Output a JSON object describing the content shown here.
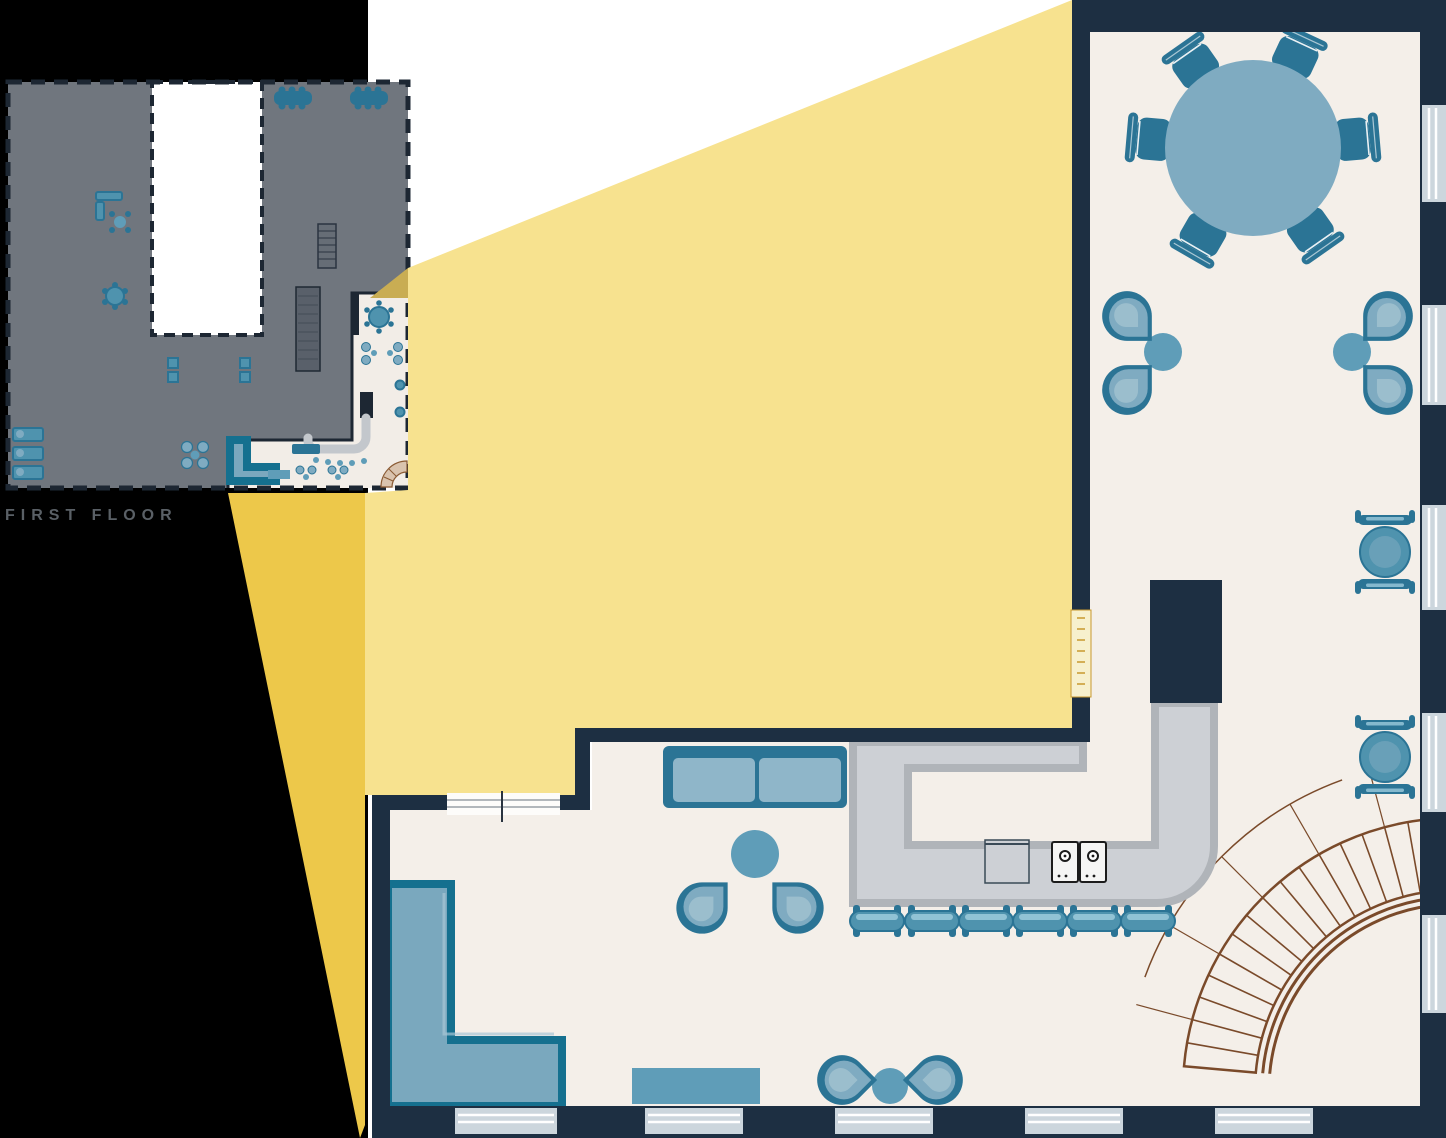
{
  "illustration": {
    "type": "architectural floor plan callout",
    "description": "Small first-floor building plan with yellow spotlight beam expanding a corner cafe/bar area into a large detailed plan"
  },
  "mini_plan": {
    "label": "FIRST FLOOR",
    "highlighted_area": "bottom-right corner cafe"
  },
  "big_plan": {
    "dining_chairs": 6,
    "bar_stools": 6,
    "lounge_chairs": 8,
    "armchairs": 2,
    "sofas": 2,
    "side_tables": 4,
    "right_wall_windows": 5,
    "bottom_wall_windows": 5,
    "appliances": [
      "sink",
      "cooktop",
      "cooktop"
    ],
    "features": [
      "round dining table",
      "bar counter",
      "L-shaped sectional sofa",
      "bench",
      "curved staircase",
      "column"
    ]
  },
  "colors": {
    "background_black": "#000000",
    "background_white": "#ffffff",
    "beam_light": "#f7e28f",
    "beam_dark": "#edc84a",
    "beam_overlap": "#c9ad53",
    "wall": "#1d2f42",
    "floor": "#f4efe9",
    "window": "#ccd6dd",
    "counter_fill": "#cdd0d5",
    "counter_edge": "#b0b4b9",
    "furniture_dark": "#2b7495",
    "furniture_mid": "#7fabc1",
    "furniture_light": "#9fc0ce",
    "stool": "#4f93ae",
    "side_table": "#5f9db8",
    "sofa_fill": "#7aa8be",
    "sofa_edge": "#15708f",
    "cushion": "#8fb6c9",
    "stair_line": "#7a4a2a",
    "stair_dot": "#a97b4f",
    "door_tick_fill": "#f7f0cd",
    "door_tick": "#c9992f",
    "mini_building": "#70767e",
    "mini_wall": "#1d2733",
    "mini_floor": "#f2ede7",
    "label": "#5a6066"
  }
}
